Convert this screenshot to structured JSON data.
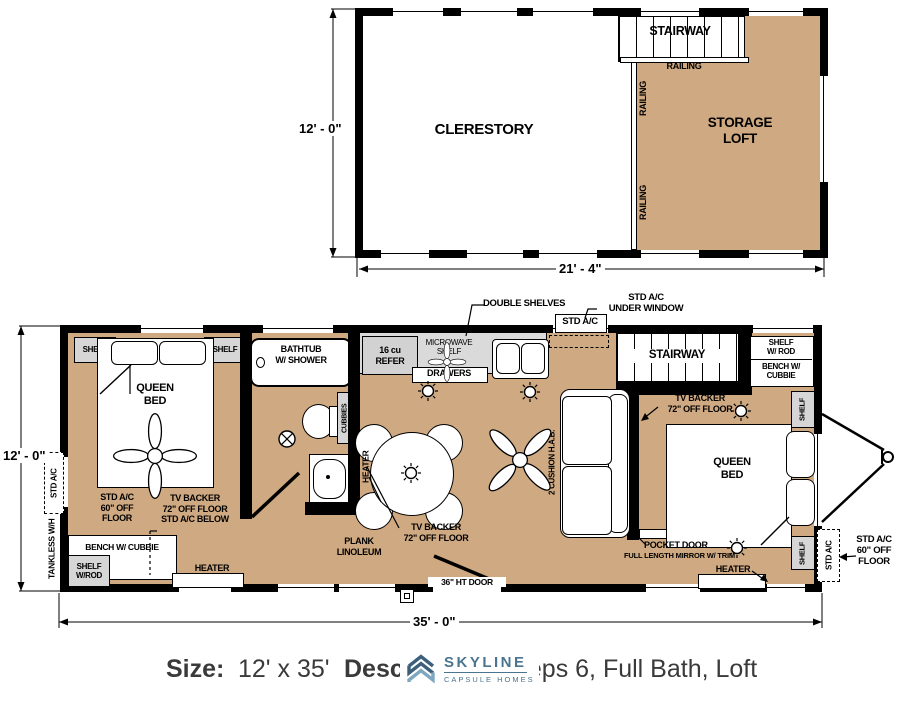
{
  "colors": {
    "floor_tan": "#CFA981",
    "counter_gray": "#DADADA",
    "shelf_gray": "#D6D6D6",
    "wall_black": "#000000",
    "logo_blue": "#4B7490",
    "logo_blue_dark": "#3C607C",
    "logo_blue_light": "#7FA8C0",
    "caption_text": "#3A3A3A"
  },
  "upper_plan": {
    "clerestory": "CLERESTORY",
    "stairway": "STAIRWAY",
    "railing_horizontal": "RAILING",
    "railing_vertical_1": "RAILING",
    "railing_vertical_2": "RAILING",
    "storage_loft": "STORAGE\nLOFT",
    "dim_height": "12' - 0\"",
    "dim_width": "21' - 4\""
  },
  "main_plan": {
    "dim_height": "12' - 0\"",
    "dim_width": "35' - 0\"",
    "top_notes": {
      "double_shelves": "DOUBLE SHELVES",
      "std_ac_under_window": "STD A/C\nUNDER WINDOW",
      "std_ac_box": "STD A/C"
    },
    "bedroom1": {
      "shelf_left": "SHELF",
      "shelf_right": "SHELF",
      "queen_bed": "QUEEN\nBED",
      "std_ac_note": "STD A/C\n60\" OFF\nFLOOR",
      "tv_backer_note": "TV BACKER\n72\" OFF FLOOR\nSTD A/C BELOW",
      "bench": "BENCH W/ CUBBIE",
      "shelf_rod": "SHELF\nW/ROD",
      "heater": "HEATER"
    },
    "left_wall": {
      "std_ac": "STD A/C",
      "tankless": "TANKLESS W/H"
    },
    "bathroom": {
      "bathtub": "BATHTUB\nW/ SHOWER",
      "cubbies": "CUBBIES",
      "heater": "HEATER"
    },
    "kitchen": {
      "refer": "16 cu\nREFER",
      "microwave_shelf": "MICROWAVE\nSHELF",
      "drawers": "DRAWERS"
    },
    "living": {
      "sofa": "2 CUSHION H.A.B.",
      "tv_backer": "TV BACKER\n72\" OFF FLOOR",
      "plank": "PLANK\nLINOLEUM",
      "door": "36\" HT DOOR",
      "stairway": "STAIRWAY"
    },
    "bedroom2": {
      "tv_backer": "TV BACKER\n72\" OFF FLOOR",
      "queen_bed": "QUEEN\nBED",
      "shelf_rod": "SHELF\nW/ ROD",
      "bench": "BENCH W/\nCUBBIE",
      "shelf_top": "SHELF",
      "shelf_bottom": "SHELF",
      "pocket_door": "POCKET DOOR",
      "mirror": "FULL LENGTH MIRROR W/ TRIM",
      "heater": "HEATER"
    },
    "right_wall": {
      "std_ac": "STD A/C",
      "std_ac_note": "STD A/C\n60\" OFF\nFLOOR"
    }
  },
  "caption": {
    "size_label": "Size:",
    "size_value": "12' x 35'",
    "desc_fragment_left": "Descr",
    "desc_fragment_right": "eeps 6, Full Bath, Loft",
    "logo_name": "SKYLINE",
    "logo_subtitle": "CAPSULE HOMES"
  }
}
